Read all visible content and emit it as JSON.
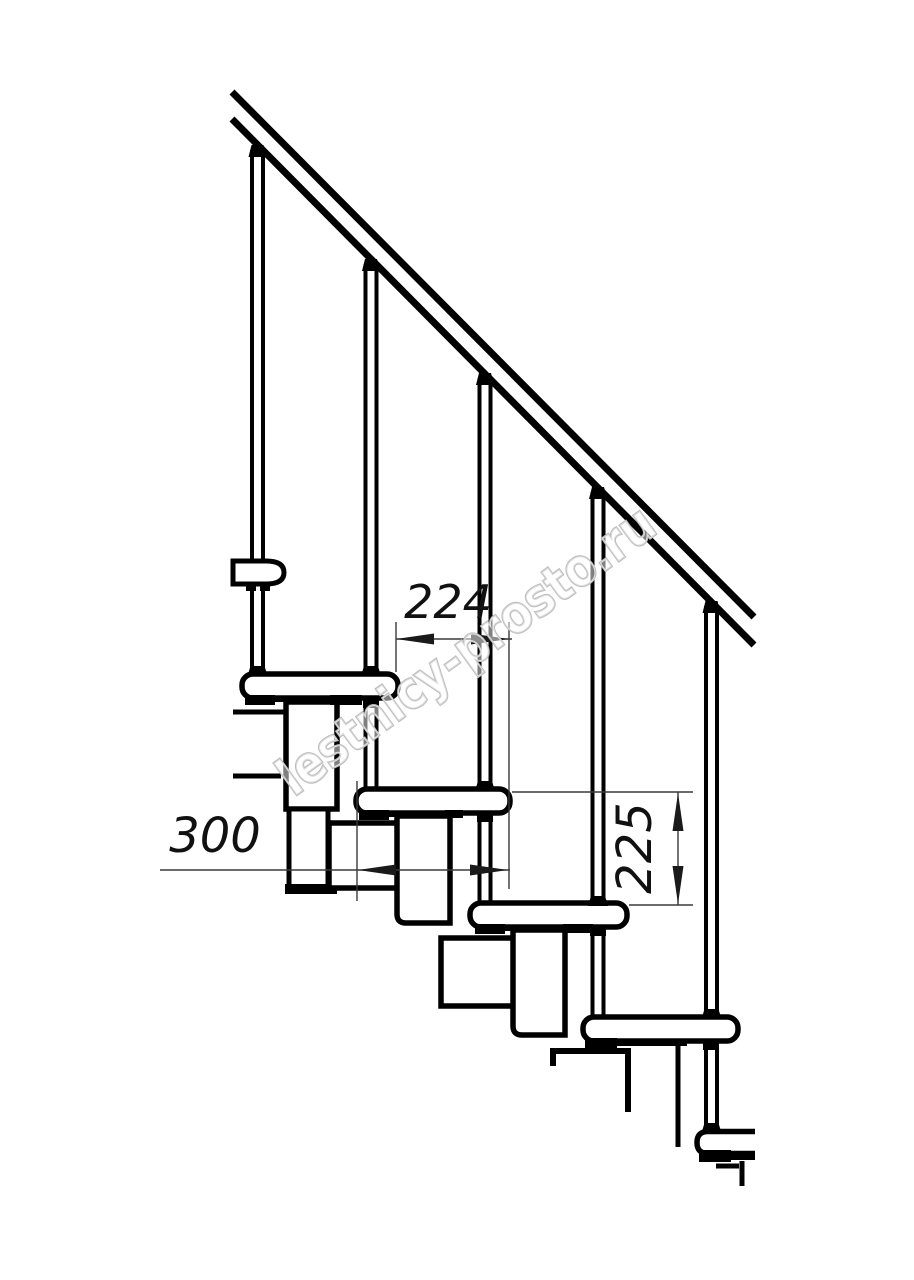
{
  "watermark": {
    "text": "lestnicy-prosto.ru"
  },
  "dimensions": {
    "run": {
      "value": "224"
    },
    "depth": {
      "value": "300"
    },
    "rise": {
      "value": "225"
    }
  },
  "palette": {
    "line": "#000000",
    "dimension_line": "#3a3a3a",
    "watermark": "#bdbdbd",
    "background": "#ffffff"
  }
}
